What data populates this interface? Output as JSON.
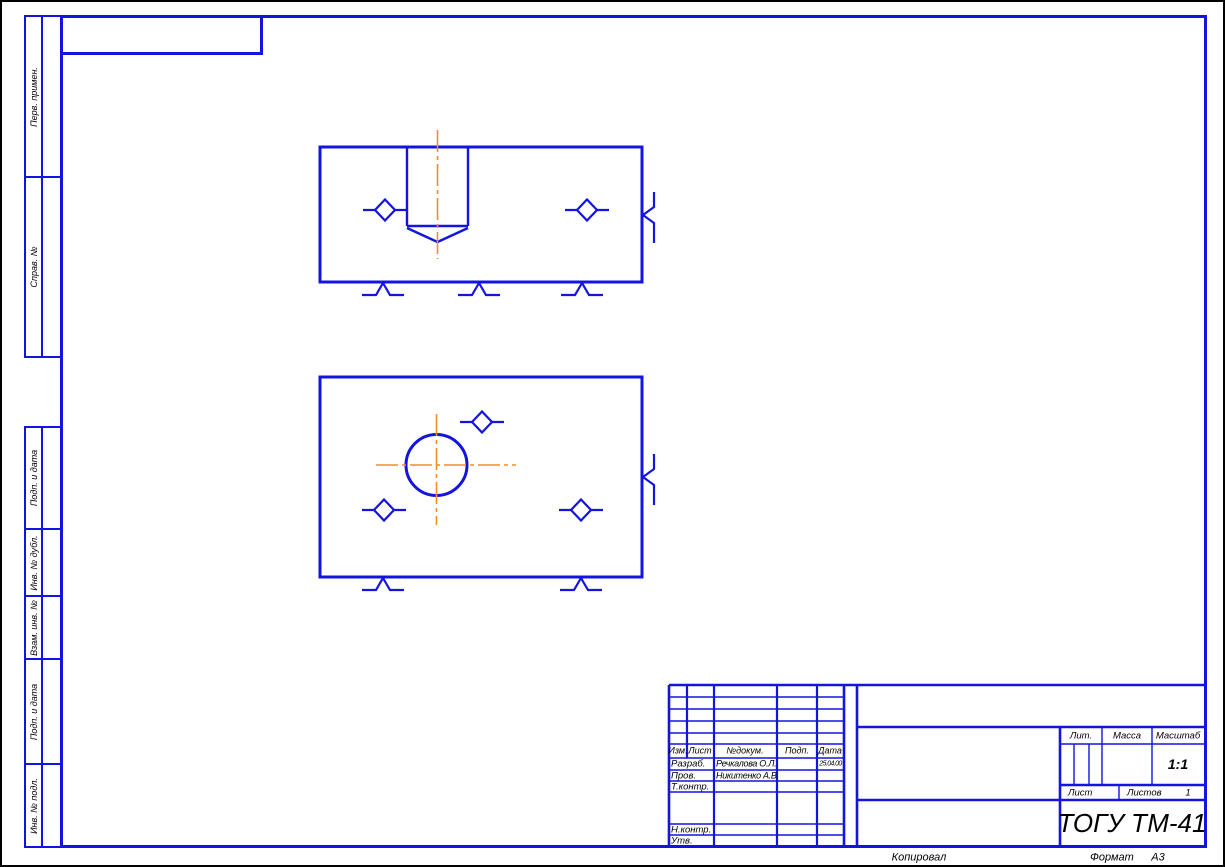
{
  "colors": {
    "line": "#1414e0",
    "centerline": "#ef8e27",
    "ink": "#000000"
  },
  "margin_labels": [
    "Перв. примен.",
    "Справ. №",
    "Подп. и дата",
    "Инв. № дубл.",
    "Взам. инв. №",
    "Подп. и дата",
    "Инв. № подл."
  ],
  "stamp": {
    "cols": {
      "izm": "Изм.",
      "sheet": "Лист",
      "doc": "№докум.",
      "sign": "Подп.",
      "date": "Дата"
    },
    "rows": [
      {
        "role": "Разраб.",
        "name": "Речкалова О.Л.",
        "date": "25.04.00"
      },
      {
        "role": "Пров.",
        "name": "Никитенко А.В.",
        "date": ""
      },
      {
        "role": "Т.контр.",
        "name": "",
        "date": ""
      },
      {
        "role": "Н.контр.",
        "name": "",
        "date": ""
      },
      {
        "role": "Утв.",
        "name": "",
        "date": ""
      }
    ],
    "lit": "Лит.",
    "mass": "Масса",
    "scale": "Масштаб",
    "scale_value": "1:1",
    "sheet": "Лист",
    "sheets": "Листов",
    "sheets_value": "1",
    "org": "ТОГУ ТМ-41"
  },
  "footer": {
    "copied": "Копировал",
    "format": "Формат",
    "format_value": "А3"
  }
}
